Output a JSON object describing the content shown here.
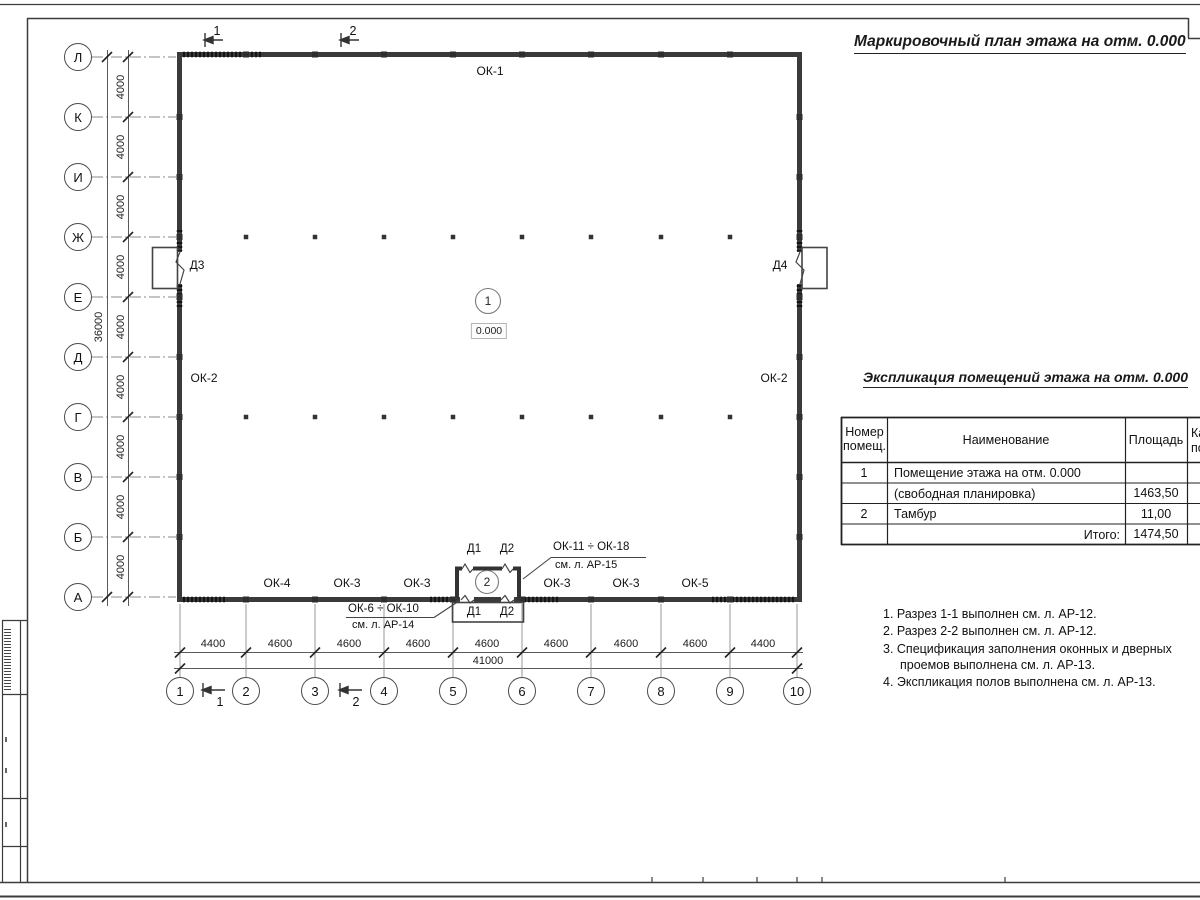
{
  "titles": {
    "plan": "Маркировочный план этажа на отм. 0.000",
    "table": "Экспликация помещений этажа на отм. 0.000"
  },
  "axes": {
    "rows": [
      "Л",
      "К",
      "И",
      "Ж",
      "Е",
      "Д",
      "Г",
      "В",
      "Б",
      "А"
    ],
    "cols": [
      "1",
      "2",
      "3",
      "4",
      "5",
      "6",
      "7",
      "8",
      "9",
      "10"
    ],
    "row_spacing": [
      "4000",
      "4000",
      "4000",
      "4000",
      "4000",
      "4000",
      "4000",
      "4000",
      "4000"
    ],
    "row_total": "36000",
    "col_spacing": [
      "4400",
      "4600",
      "4600",
      "4600",
      "4600",
      "4600",
      "4600",
      "4600",
      "4400"
    ],
    "col_total": "41000"
  },
  "plan_labels": {
    "ok1": "ОК-1",
    "ok2_left": "ОК-2",
    "ok2_right": "ОК-2",
    "d3": "Д3",
    "d4": "Д4",
    "bottom_windows": [
      "ОК-4",
      "ОК-3",
      "ОК-3",
      "ОК-3",
      "ОК-3",
      "ОК-5"
    ],
    "tambour_top": [
      "Д1",
      "Д2"
    ],
    "tambour_bottom": [
      "Д1",
      "Д2"
    ],
    "room_mark": "1",
    "room_elevation": "0.000",
    "tambour_mark": "2",
    "leader_top_line1": "ОК-11 ÷ ОК-18",
    "leader_top_line2": "см. л. АР-15",
    "leader_bottom_line1": "ОК-6 ÷ ОК-10",
    "leader_bottom_line2": "см. л. АР-14",
    "section_top_1": "1",
    "section_top_2": "2",
    "section_bottom_1": "1",
    "section_bottom_2": "2"
  },
  "table": {
    "header_col1": "Номер помещ.",
    "header_col2": "Наименование",
    "header_col3": "Площадь",
    "header_col4_line1": "Ка",
    "header_col4_line2": "по",
    "rows": [
      {
        "num": "1",
        "name": "Помещение этажа на отм. 0.000",
        "area": ""
      },
      {
        "num": "",
        "name": "(свободная планировка)",
        "area": "1463,50"
      },
      {
        "num": "2",
        "name": "Тамбур",
        "area": "11,00"
      }
    ],
    "total_label": "Итого:",
    "total_value": "1474,50"
  },
  "notes": [
    "1. Разрез 1-1 выполнен см. л. АР-12.",
    "2. Разрез 2-2 выполнен см. л. АР-12.",
    "3. Спецификация заполнения оконных и дверных проемов выполнена см. л. АР-13.",
    "4. Экспликация полов выполнена см. л. АР-13."
  ]
}
